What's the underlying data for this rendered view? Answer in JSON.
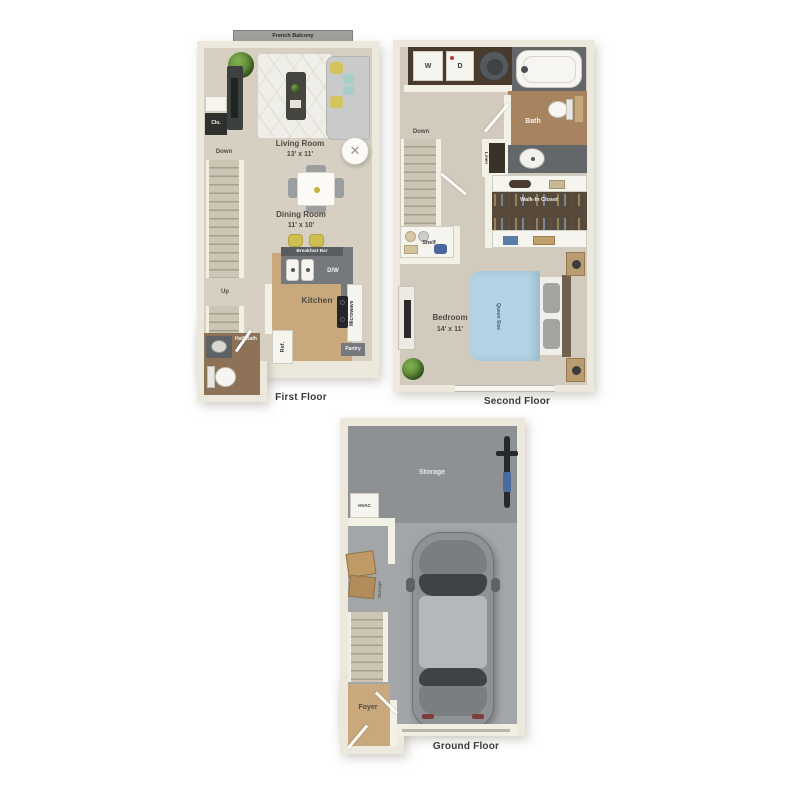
{
  "first_floor": {
    "caption": "First Floor",
    "balcony": "French Balcony",
    "closet": "Clo.",
    "down": "Down",
    "up": "Up",
    "living_room": "Living Room",
    "living_room_dims": "13' x 11'",
    "dining_room": "Dining Room",
    "dining_room_dims": "11' x 10'",
    "breakfast_bar": "Breakfast Bar",
    "dishwasher": "D/W",
    "kitchen": "Kitchen",
    "microwave": "Microwave",
    "pantry": "Pantry",
    "refrigerator": "Ref.",
    "half_bath": "Half Bath"
  },
  "second_floor": {
    "caption": "Second Floor",
    "washer": "W",
    "dryer": "D",
    "bath": "Bath",
    "down": "Down",
    "linen": "Linen",
    "walk_in_closet": "Walk-In Closet",
    "shelf": "Shelf",
    "bedroom": "Bedroom",
    "bedroom_dims": "14' x 11'",
    "queen_size": "Queen Size"
  },
  "ground_floor": {
    "caption": "Ground Floor",
    "storage_area": "Storage",
    "hvac": "HVAC",
    "storage_boxes": "Storage",
    "foyer": "Foyer"
  },
  "colors": {
    "wall": "#ece8dc",
    "floor_beige": "#d6cfc2",
    "kitchen_wood": "#c8a87c",
    "dark_wood": "#8d7258",
    "counter_gray": "#75797d",
    "closet_brown": "#584a3a",
    "bed_blue": "#b4d3e5",
    "garage_floor": "#a3a6a8",
    "storage_floor": "#8e9193",
    "label_text": "#514c44"
  }
}
